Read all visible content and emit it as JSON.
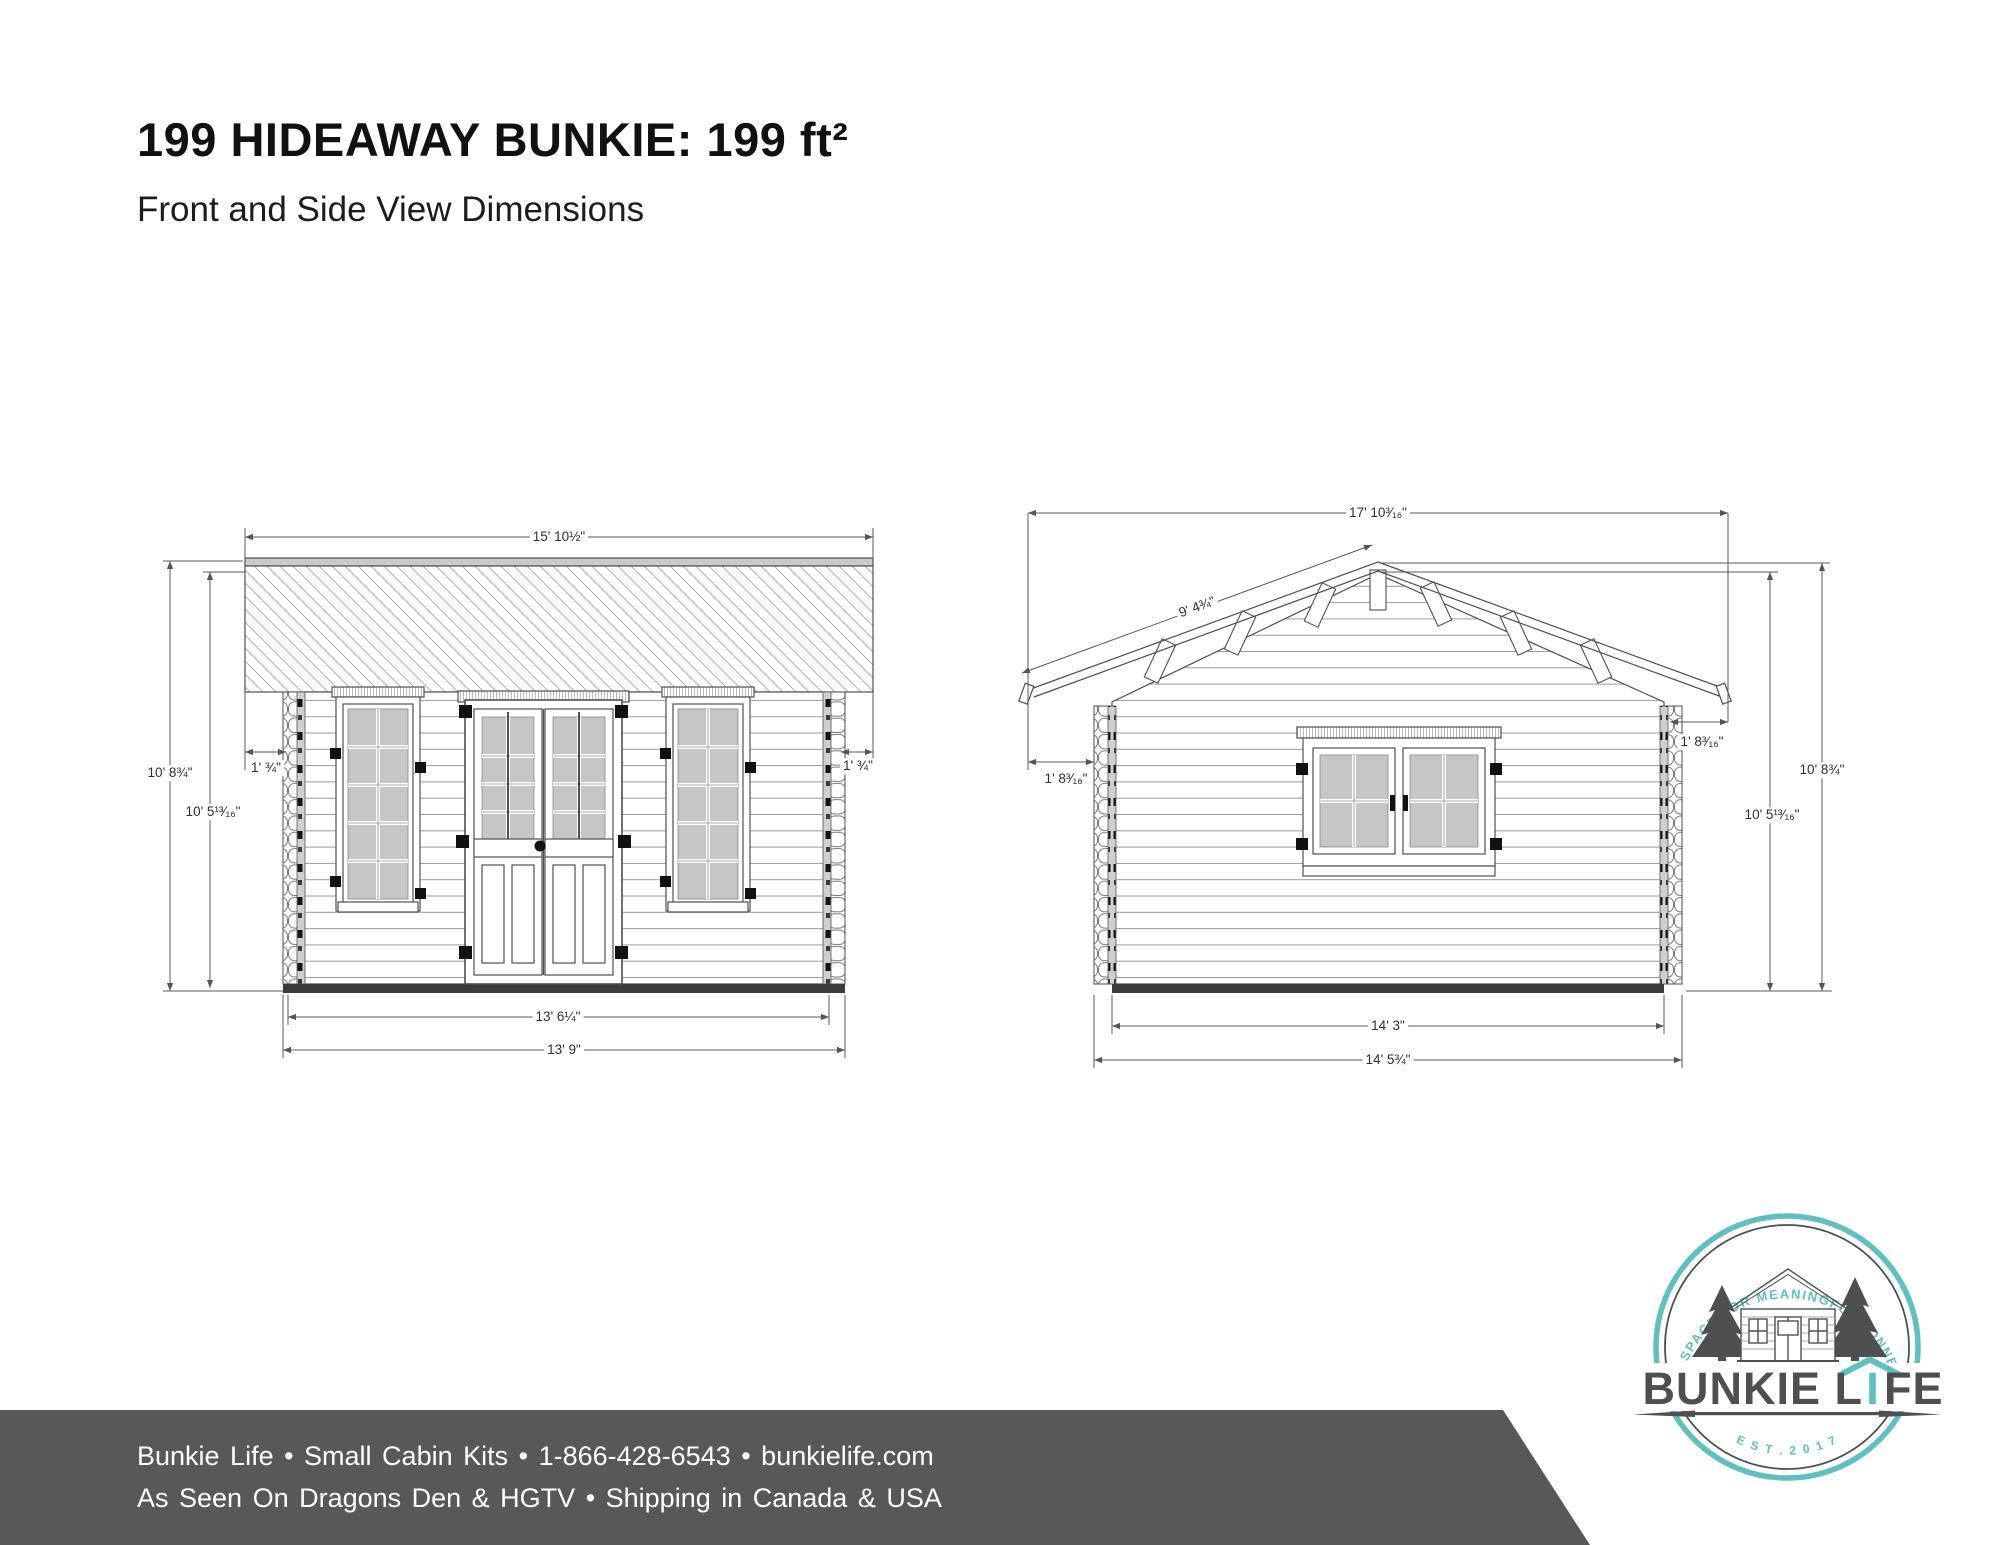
{
  "page": {
    "title": "199 HIDEAWAY BUNKIE: 199 ft²",
    "subtitle": "Front and Side View Dimensions"
  },
  "front_view": {
    "name": "front-elevation",
    "dimensions": {
      "roof_width": "15' 10½\"",
      "total_height": "10' 8¾\"",
      "wall_height": "10' 5¹³⁄₁₆\"",
      "overhang_left": "1' ¾\"",
      "overhang_right": "1' ¾\"",
      "wall_width": "13' 6¼\"",
      "base_width": "13' 9\""
    }
  },
  "side_view": {
    "name": "side-elevation",
    "dimensions": {
      "roof_width": "17' 10³⁄₁₆\"",
      "roof_slope_length": "9' 4¾\"",
      "overhang_left": "1' 8³⁄₁₆\"",
      "overhang_right": "1' 8³⁄₁₆\"",
      "total_height": "10' 8¾\"",
      "wall_height": "10' 5¹³⁄₁₆\"",
      "floor_width": "14' 3\"",
      "base_width": "14' 5¾\""
    }
  },
  "logo": {
    "arc_text": "EXTRA SPACE FOR MEANINGFUL CONNECTION",
    "brand": "BUNKIE LIFE",
    "brand_left": "BUNKIE L",
    "brand_i": "I",
    "brand_right": "FE",
    "established": "E S T .   2 0 1 7",
    "teal_color": "#5fc0c1",
    "dark_color": "#4e4f51"
  },
  "footer": {
    "line1": "Bunkie Life  •  Small Cabin Kits  •  1-866-428-6543  •  bunkielife.com",
    "line2": "As Seen On Dragons Den & HGTV  •  Shipping in Canada & USA",
    "background_color": "#57585a"
  }
}
